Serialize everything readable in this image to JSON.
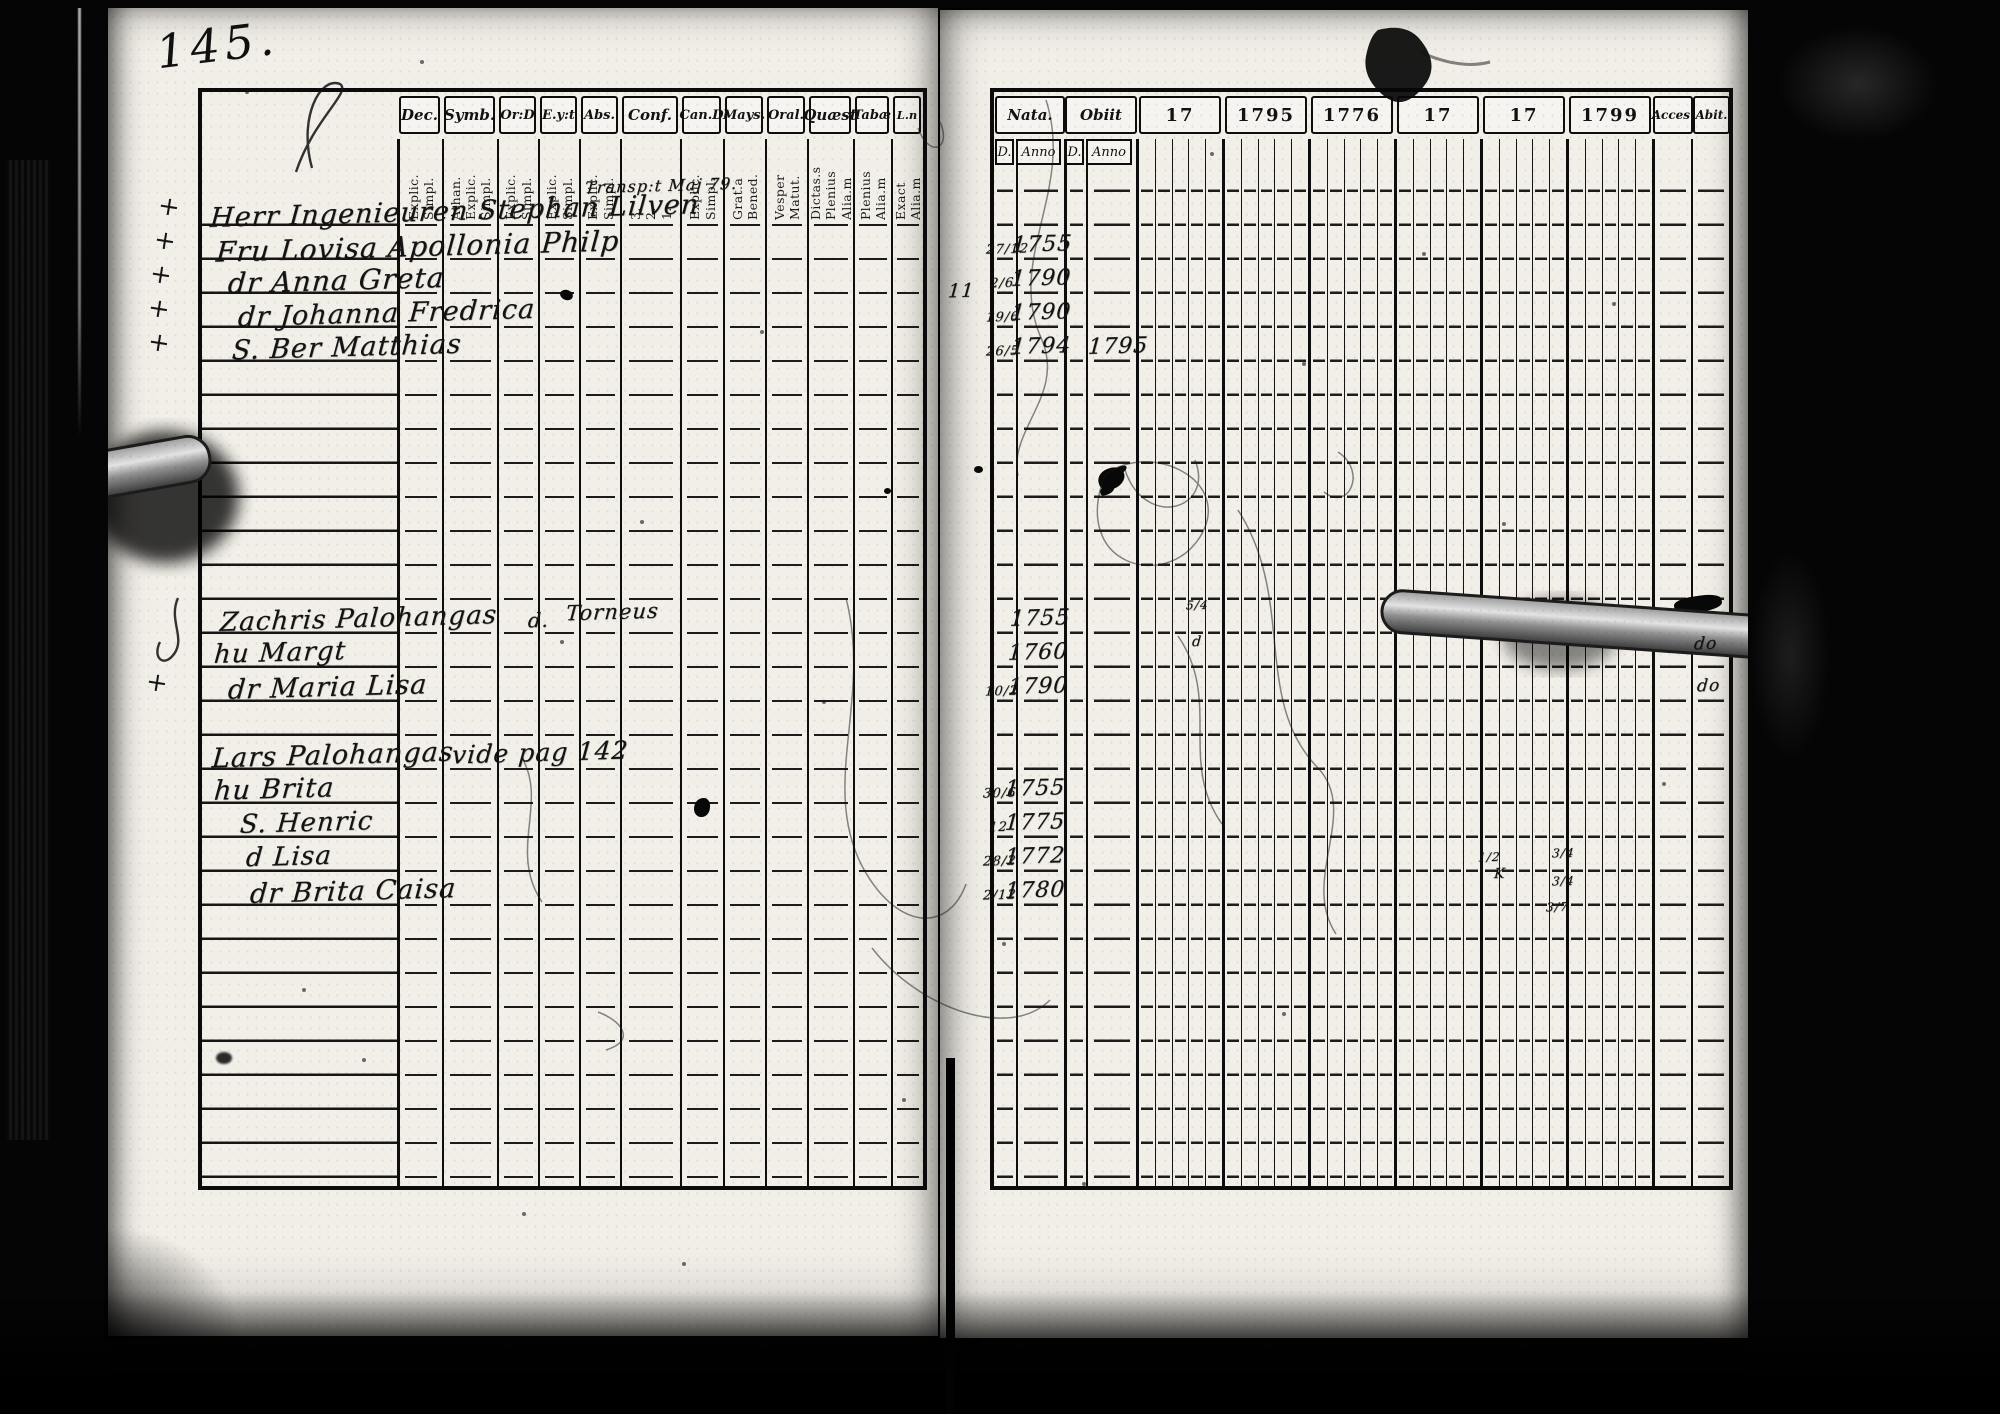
{
  "page_number": "145.",
  "left_table": {
    "columns": [
      {
        "label": "Dec.",
        "subs": [
          "Explic.",
          "Simpl."
        ],
        "w": 45
      },
      {
        "label": "Symb.",
        "subs": [
          "Athan.",
          "Explic.",
          "Simpl."
        ],
        "w": 55
      },
      {
        "label": "Or:D",
        "subs": [
          "Explic.",
          "Simpl."
        ],
        "w": 41
      },
      {
        "label": "E.y:t",
        "subs": [
          "Explic.",
          "Simpl."
        ],
        "w": 41
      },
      {
        "label": "Abs.",
        "subs": [
          "Explic.",
          "Simpl."
        ],
        "w": 41
      },
      {
        "label": "Conf.",
        "subs": [
          "3.",
          "2.",
          "1."
        ],
        "w": 60
      },
      {
        "label": "Can.D",
        "subs": [
          "Explic.",
          "Simpl."
        ],
        "w": 43
      },
      {
        "label": "Mays.",
        "subs": [
          "Grat.a",
          "Bened."
        ],
        "w": 42
      },
      {
        "label": "Oral.",
        "subs": [
          "Vesper",
          "Matut."
        ],
        "w": 42
      },
      {
        "label": "Quæst",
        "subs": [
          "Dictas.s",
          "Plenius",
          "Alia.m"
        ],
        "w": 46
      },
      {
        "label": "Tabæ",
        "subs": [
          "Plenius",
          "Alia.m"
        ],
        "w": 38
      },
      {
        "label": "L.n",
        "subs": [
          "Exact",
          "Alia.m"
        ],
        "w": 32
      }
    ]
  },
  "right_table": {
    "nata_label": "Nata.",
    "obiit_label": "Obiit",
    "sub_headers": [
      "D.",
      "Anno",
      "D.",
      "Anno"
    ],
    "year_columns": [
      "17",
      "1795",
      "1776",
      "17",
      "17",
      "1799"
    ],
    "acces_label": "Acces.",
    "abit_label": "Abit."
  },
  "handwriting_left": [
    {
      "text": "Herr Ingenieuren Stephan Lilven",
      "x": 210,
      "y": 196,
      "size": 27
    },
    {
      "text": "Fru Lovisa Apollonia Philp",
      "x": 216,
      "y": 230,
      "size": 28
    },
    {
      "text": "dr Anna Greta",
      "x": 228,
      "y": 264,
      "size": 28
    },
    {
      "text": "dr Johanna Fredrica",
      "x": 238,
      "y": 298,
      "size": 27
    },
    {
      "text": "S. Ber Matthias",
      "x": 232,
      "y": 332,
      "size": 27
    },
    {
      "text": "Zachris Palohangas",
      "x": 220,
      "y": 604,
      "size": 26
    },
    {
      "text": "d.",
      "x": 528,
      "y": 608,
      "size": 20
    },
    {
      "text": "Torneus",
      "x": 566,
      "y": 600,
      "size": 21
    },
    {
      "text": "hu Margt",
      "x": 214,
      "y": 638,
      "size": 26
    },
    {
      "text": "dr Maria Lisa",
      "x": 228,
      "y": 672,
      "size": 27
    },
    {
      "text": "Lars Palohangas",
      "x": 212,
      "y": 740,
      "size": 27
    },
    {
      "text": "vide pag 142",
      "x": 452,
      "y": 738,
      "size": 25
    },
    {
      "text": "hu Brita",
      "x": 214,
      "y": 774,
      "size": 27
    },
    {
      "text": "S. Henric",
      "x": 240,
      "y": 808,
      "size": 26
    },
    {
      "text": "d Lisa",
      "x": 246,
      "y": 842,
      "size": 26
    },
    {
      "text": "dr Brita Caisa",
      "x": 250,
      "y": 876,
      "size": 27
    },
    {
      "text": "Transp:t Maj 79.",
      "x": 585,
      "y": 176,
      "size": 16
    }
  ],
  "handwriting_right": [
    {
      "text": "27/12",
      "x": 986,
      "y": 242,
      "size": 13
    },
    {
      "text": "1755",
      "x": 1012,
      "y": 232,
      "size": 22
    },
    {
      "text": "2/6",
      "x": 990,
      "y": 276,
      "size": 13
    },
    {
      "text": "1790",
      "x": 1011,
      "y": 266,
      "size": 22
    },
    {
      "text": "19/6",
      "x": 986,
      "y": 310,
      "size": 13
    },
    {
      "text": "1790",
      "x": 1011,
      "y": 300,
      "size": 22
    },
    {
      "text": "26/5",
      "x": 986,
      "y": 344,
      "size": 13
    },
    {
      "text": "1794",
      "x": 1011,
      "y": 334,
      "size": 22
    },
    {
      "text": "1795",
      "x": 1088,
      "y": 334,
      "size": 22
    },
    {
      "text": "1755",
      "x": 1010,
      "y": 606,
      "size": 22
    },
    {
      "text": "1760",
      "x": 1008,
      "y": 640,
      "size": 22
    },
    {
      "text": "10/2",
      "x": 985,
      "y": 684,
      "size": 13
    },
    {
      "text": "1790",
      "x": 1008,
      "y": 674,
      "size": 22
    },
    {
      "text": "30/6",
      "x": 983,
      "y": 786,
      "size": 13
    },
    {
      "text": "1755",
      "x": 1005,
      "y": 776,
      "size": 22
    },
    {
      "text": "12",
      "x": 989,
      "y": 820,
      "size": 13
    },
    {
      "text": "1775",
      "x": 1005,
      "y": 810,
      "size": 22
    },
    {
      "text": "28/2",
      "x": 983,
      "y": 854,
      "size": 13
    },
    {
      "text": "1772",
      "x": 1005,
      "y": 844,
      "size": 22
    },
    {
      "text": "2/12",
      "x": 983,
      "y": 888,
      "size": 13
    },
    {
      "text": "1780",
      "x": 1005,
      "y": 878,
      "size": 22
    },
    {
      "text": "11",
      "x": 948,
      "y": 280,
      "size": 19
    },
    {
      "text": "5/4",
      "x": 1186,
      "y": 598,
      "size": 12
    },
    {
      "text": "d",
      "x": 1192,
      "y": 634,
      "size": 14
    },
    {
      "text": "3/4",
      "x": 1552,
      "y": 846,
      "size": 12
    },
    {
      "text": "3/4",
      "x": 1552,
      "y": 874,
      "size": 12
    },
    {
      "text": "3/7",
      "x": 1546,
      "y": 900,
      "size": 12
    },
    {
      "text": "1/2",
      "x": 1478,
      "y": 850,
      "size": 12
    },
    {
      "text": "K",
      "x": 1494,
      "y": 866,
      "size": 14
    },
    {
      "text": "do",
      "x": 1694,
      "y": 634,
      "size": 17
    },
    {
      "text": "do",
      "x": 1697,
      "y": 676,
      "size": 17
    }
  ],
  "margin_marks": [
    {
      "text": "+",
      "x": 158,
      "y": 192
    },
    {
      "text": "+",
      "x": 154,
      "y": 226
    },
    {
      "text": "+",
      "x": 150,
      "y": 260
    },
    {
      "text": "+",
      "x": 148,
      "y": 294
    },
    {
      "text": "+",
      "x": 148,
      "y": 328
    },
    {
      "text": "+",
      "x": 146,
      "y": 668
    }
  ],
  "colors": {
    "page": "#f2efe8",
    "ink": "#131313",
    "line": "#111111",
    "film": "#040404"
  }
}
